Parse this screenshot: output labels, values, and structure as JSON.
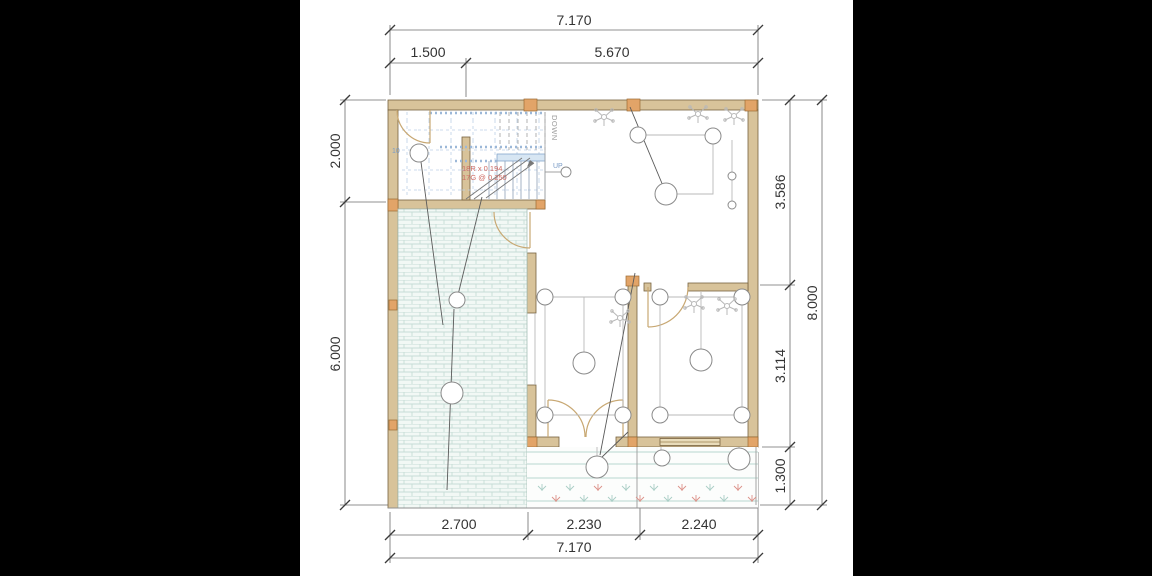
{
  "plan": {
    "dims_top": {
      "total": "7.170",
      "seg1": "1.500",
      "seg2": "5.670"
    },
    "dims_bottom": {
      "total": "7.170",
      "seg1": "2.700",
      "seg2": "2.230",
      "seg3": "2.240"
    },
    "dims_left": {
      "seg1": "2.000",
      "seg2": "6.000"
    },
    "dims_right": {
      "total": "8.000",
      "seg1": "3.586",
      "seg2": "3.114",
      "seg3": "1.300"
    },
    "stairs": {
      "note1": "18R x 0.194",
      "note2": "17G @ 0.250",
      "down": "DOWN",
      "up": "UP",
      "grid": "10"
    }
  },
  "colors": {
    "wall": "#d8c39a",
    "wall_cap": "#e2a468",
    "brick_line": "#c6ddd6",
    "dim_line": "#6b6b6b",
    "stair_note": "#cf6b63",
    "light_symbol": "#8a8a8a"
  }
}
